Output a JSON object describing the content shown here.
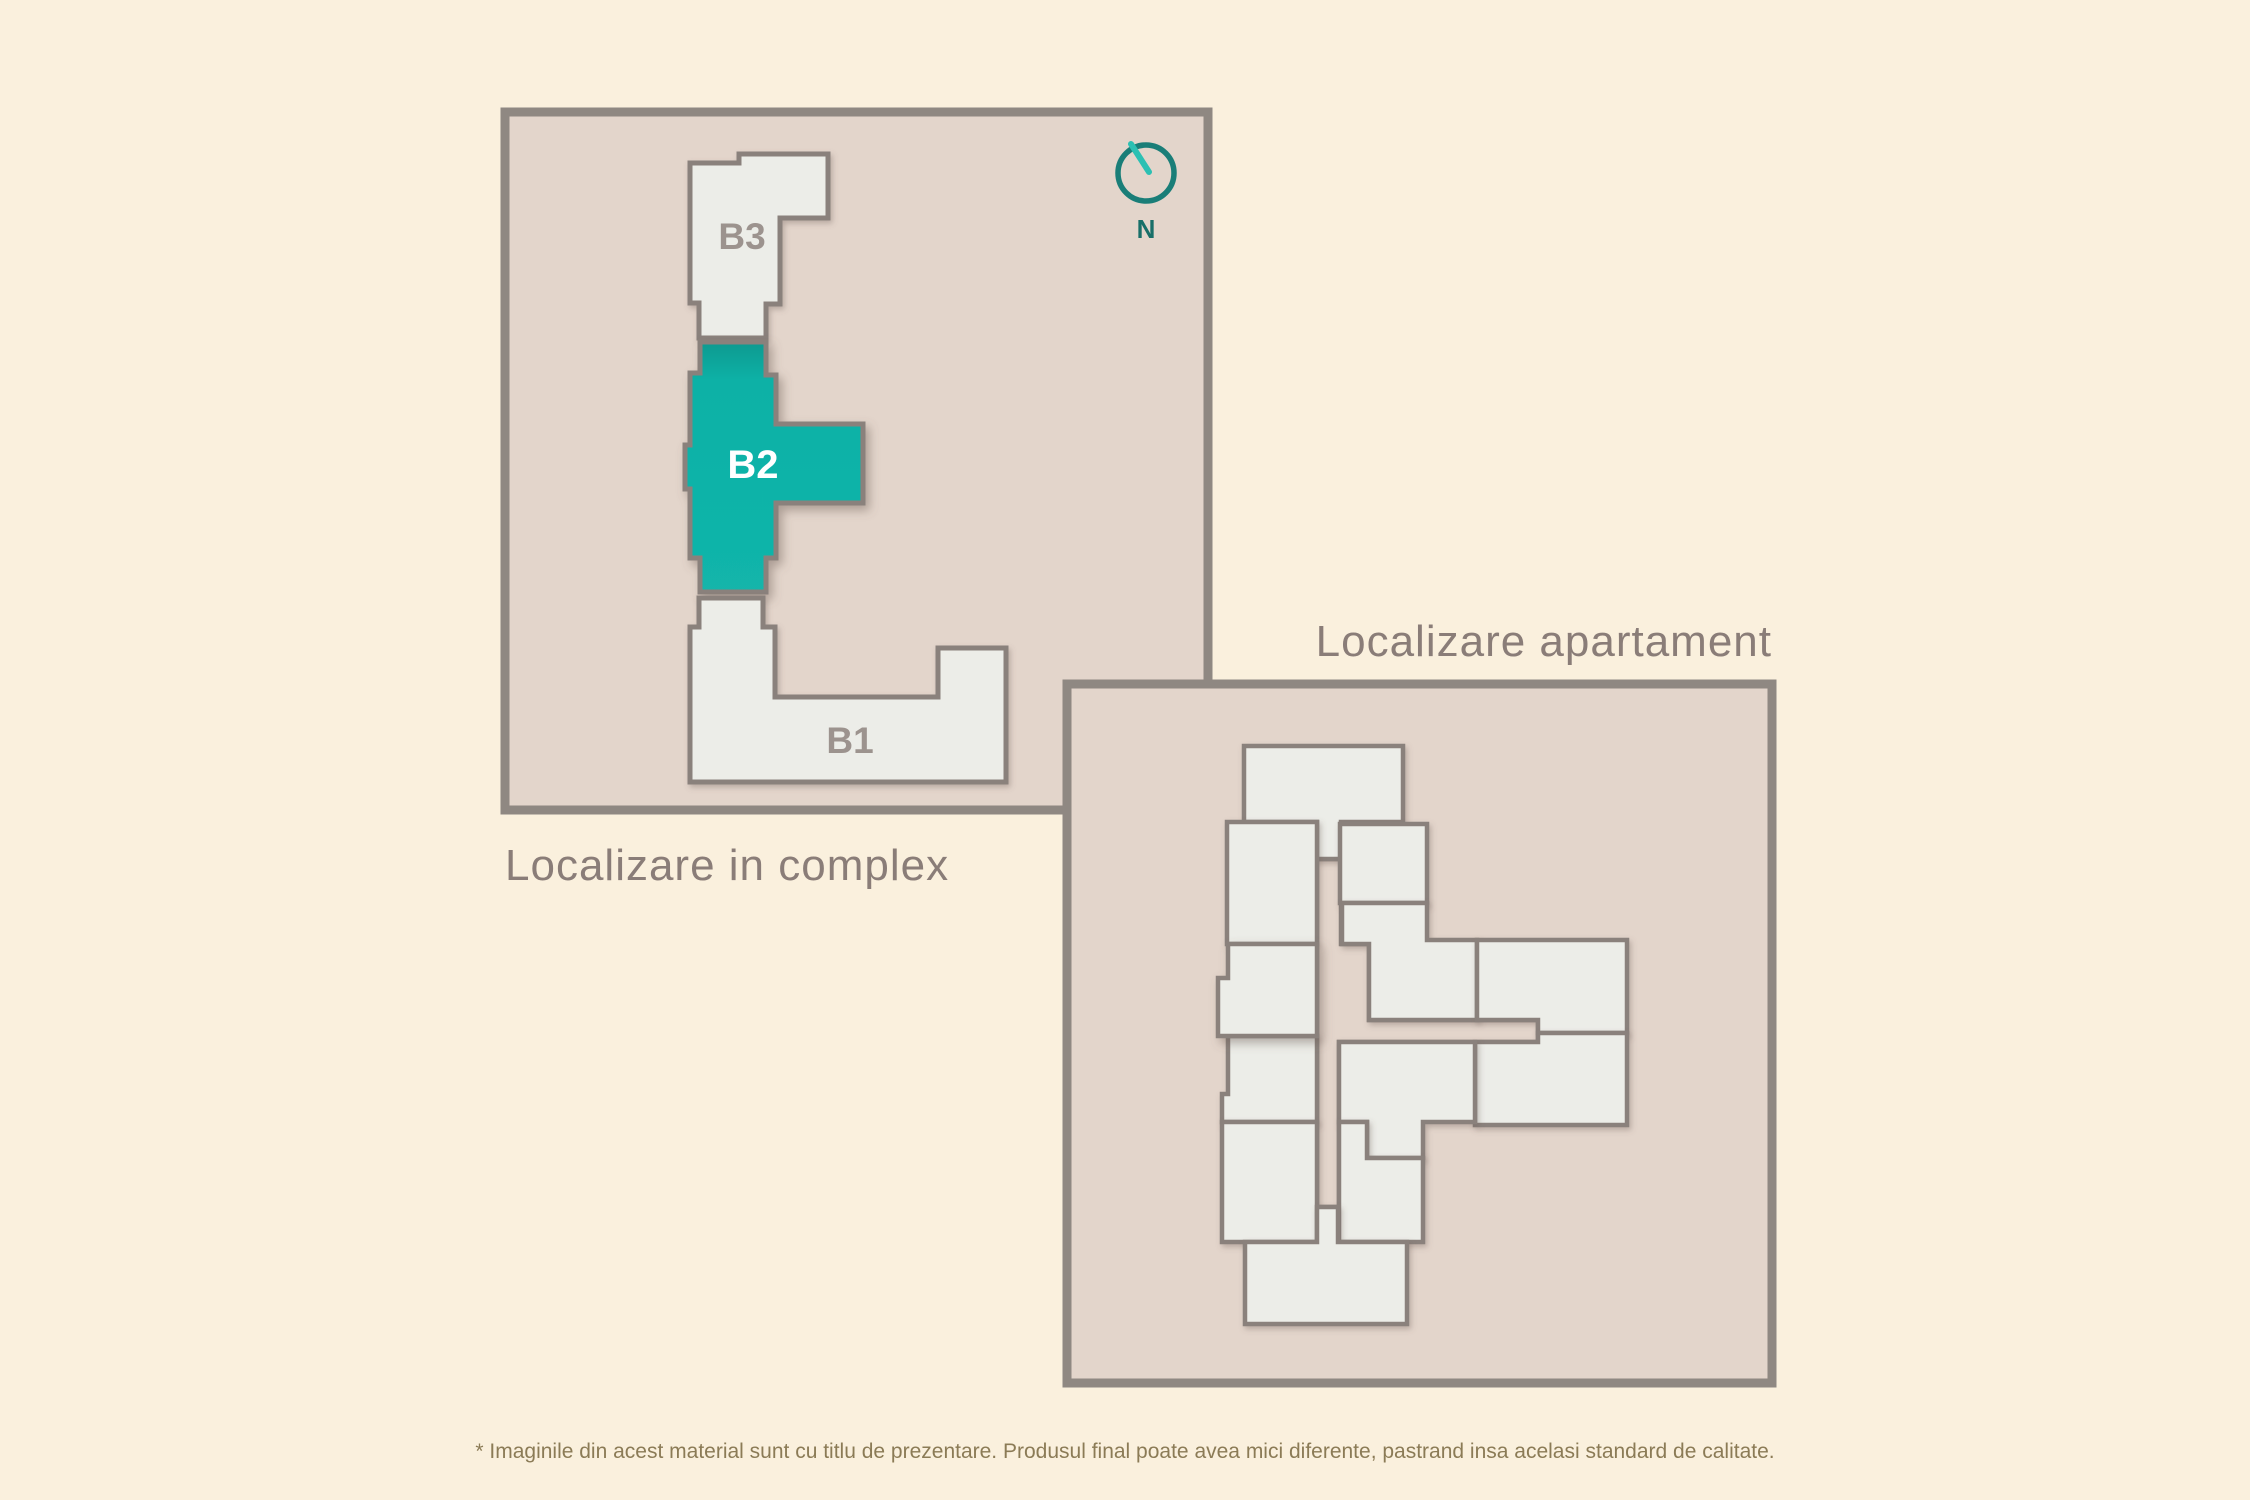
{
  "colors": {
    "page_background": "#faf0dd",
    "panel_fill": "#e3d5cb",
    "panel_border": "#8f8882",
    "room_fill": "#ecede8",
    "wall_stroke": "#8a817c",
    "accent_teal": "#0fb3a8",
    "accent_teal_dark": "#089a90",
    "title_text": "#8a7d78",
    "building_label_text": "#9c938e",
    "highlighted_label_text": "#ffffff",
    "disclaimer_text": "#8b7b56",
    "compass_teal": "#1a7e78"
  },
  "complex_map": {
    "title": "Localizare in complex",
    "compass": {
      "label": "N"
    },
    "buildings": [
      {
        "label": "B3",
        "highlighted": false
      },
      {
        "label": "B2",
        "highlighted": true
      },
      {
        "label": "B1",
        "highlighted": false
      }
    ]
  },
  "apartment_map": {
    "title": "Localizare apartament",
    "highlighted_unit": "selected apartment"
  },
  "footer": {
    "disclaimer": "* Imaginile din acest material sunt cu titlu de prezentare. Produsul final poate avea mici diferente, pastrand insa acelasi standard de calitate."
  }
}
